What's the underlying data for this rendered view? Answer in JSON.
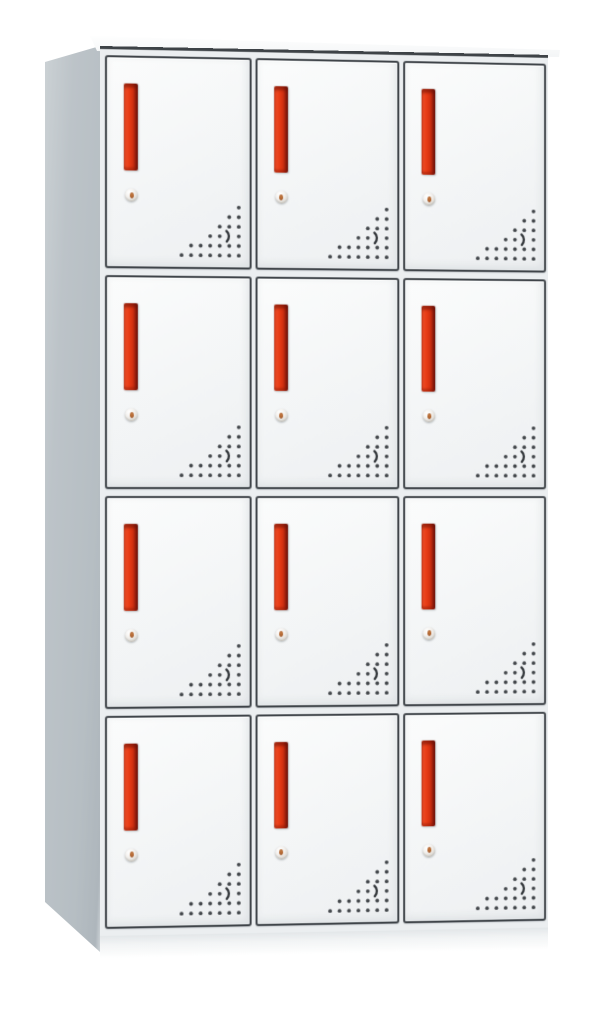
{
  "meta": {
    "description": "Product photograph of a light-grey steel locker cabinet with twelve compartments, viewed slightly from the left",
    "scene": "white studio background, no text or labels visible"
  },
  "cabinet": {
    "rows": 4,
    "columns": 3,
    "door_count": 12,
    "doors": [
      {
        "id": "locker-door-r1-c1",
        "row": 1,
        "col": 1
      },
      {
        "id": "locker-door-r1-c2",
        "row": 1,
        "col": 2
      },
      {
        "id": "locker-door-r1-c3",
        "row": 1,
        "col": 3
      },
      {
        "id": "locker-door-r2-c1",
        "row": 2,
        "col": 1
      },
      {
        "id": "locker-door-r2-c2",
        "row": 2,
        "col": 2
      },
      {
        "id": "locker-door-r2-c3",
        "row": 2,
        "col": 3
      },
      {
        "id": "locker-door-r3-c1",
        "row": 3,
        "col": 1
      },
      {
        "id": "locker-door-r3-c2",
        "row": 3,
        "col": 2
      },
      {
        "id": "locker-door-r3-c3",
        "row": 3,
        "col": 3
      },
      {
        "id": "locker-door-r4-c1",
        "row": 4,
        "col": 1
      },
      {
        "id": "locker-door-r4-c2",
        "row": 4,
        "col": 2
      },
      {
        "id": "locker-door-r4-c3",
        "row": 4,
        "col": 3
      }
    ],
    "door_features": {
      "handle": "vertical-red-recessed-pull-handle",
      "lock": "round-silver-cam-lock-with-keyhole",
      "vents": "triangular-perforated-vent-hole-pattern-bottom-right"
    },
    "colors": {
      "background": "#ffffff",
      "side_panel": "#b6bec3",
      "side_panel_light": "#ccd2d5",
      "door_face": "#f4f5f6",
      "door_frame": "#3f4449",
      "handle_red": "#e63a14",
      "handle_red_light": "#f0512a",
      "handle_red_dark": "#6e130a",
      "lock_body": "#dcd9d3",
      "lock_keyhole": "#c2763d",
      "vent_dot": "#43474b",
      "plinth": "#f2f4f5"
    }
  }
}
